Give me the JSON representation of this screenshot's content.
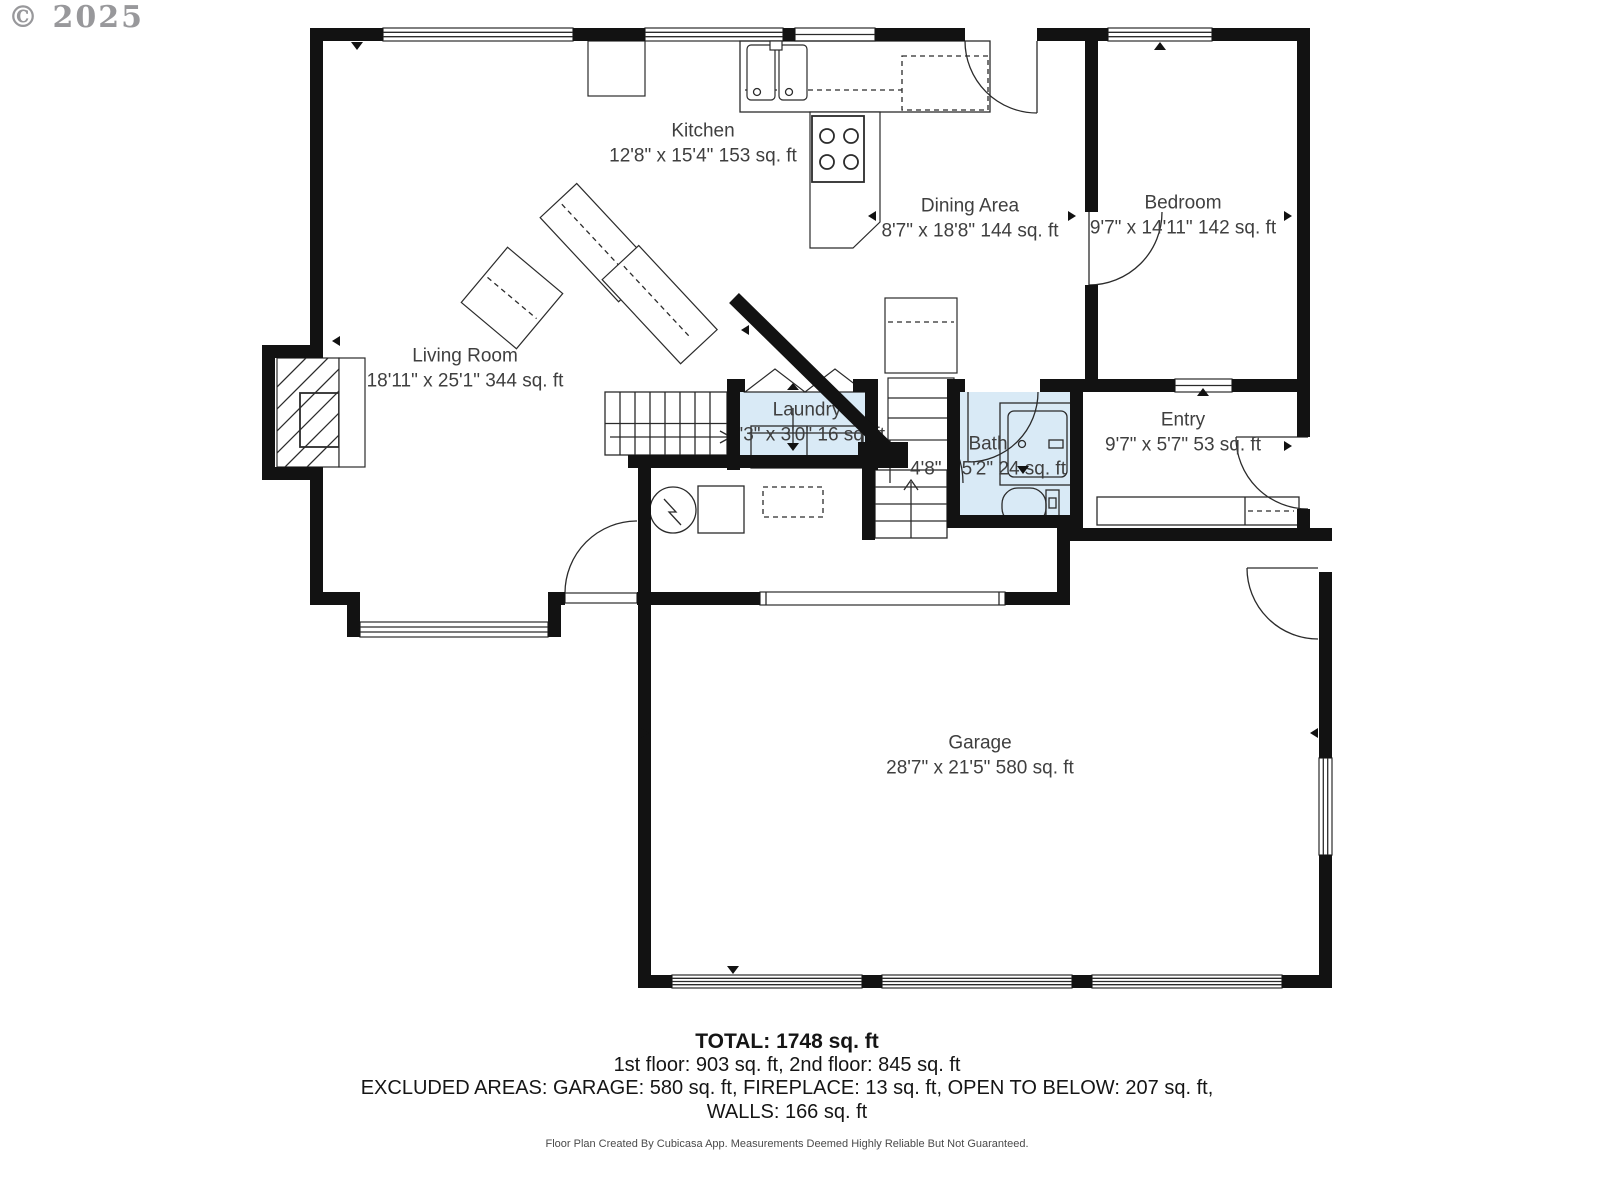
{
  "copyright": "© 2025",
  "colors": {
    "wall": "#121212",
    "room_highlight": "#d9eaf6",
    "label_text": "#3f3f3f"
  },
  "rooms": {
    "kitchen": {
      "name": "Kitchen",
      "dims": "12'8\" x 15'4\" 153 sq. ft"
    },
    "dining": {
      "name": "Dining Area",
      "dims": "8'7\" x 18'8\" 144 sq. ft"
    },
    "bedroom": {
      "name": "Bedroom",
      "dims": "9'7\" x 14'11\" 142 sq. ft"
    },
    "living": {
      "name": "Living Room",
      "dims": "18'11\" x 25'1\" 344 sq. ft"
    },
    "laundry": {
      "name": "Laundry",
      "dims": "5'3\" x 3'0\" 16 sq. ft"
    },
    "bath": {
      "name": "Bath",
      "dims": "4'8\" x 5'2\" 24 sq. ft"
    },
    "entry": {
      "name": "Entry",
      "dims": "9'7\" x 5'7\" 53 sq. ft"
    },
    "garage": {
      "name": "Garage",
      "dims": "28'7\" x 21'5\" 580 sq. ft"
    }
  },
  "summary": {
    "total": "TOTAL: 1748 sq. ft",
    "floors": "1st floor: 903 sq. ft, 2nd floor: 845 sq. ft",
    "excluded": "EXCLUDED AREAS: GARAGE: 580 sq. ft, FIREPLACE: 13 sq. ft, OPEN TO BELOW: 207 sq. ft,",
    "walls": "WALLS: 166 sq. ft"
  },
  "footer": "Floor Plan Created By Cubicasa App. Measurements Deemed Highly Reliable But Not Guaranteed."
}
